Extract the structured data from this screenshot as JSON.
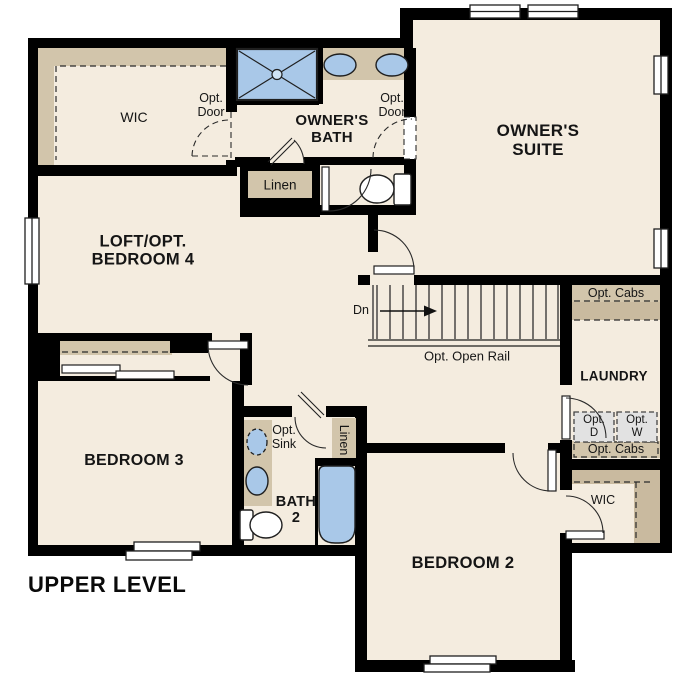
{
  "plan": {
    "title": "UPPER LEVEL",
    "rooms": {
      "owners_suite": "OWNER'S SUITE",
      "owners_bath": "OWNER'S BATH",
      "loft": "LOFT/OPT. BEDROOM 4",
      "bedroom3": "BEDROOM 3",
      "bedroom2": "BEDROOM 2",
      "bath2": "BATH 2",
      "laundry": "LAUNDRY",
      "wic": "WIC"
    },
    "annotations": {
      "opt_door": "Opt. Door",
      "linen": "Linen",
      "dn": "Dn",
      "opt_open_rail": "Opt. Open Rail",
      "opt_cabs": "Opt. Cabs",
      "opt_d": "Opt. D",
      "opt_w": "Opt. W",
      "opt_sink": "Opt. Sink"
    },
    "colors": {
      "wall": "#000000",
      "floor": "#f4ecdf",
      "shelf": "#d2c5ab",
      "shelf_dark": "#c9ba9f",
      "fixture": "#a9c8e8",
      "fixture_light": "#cfe3f5",
      "appliance": "#e2e2e2",
      "outline": "#1f1f1f"
    }
  }
}
